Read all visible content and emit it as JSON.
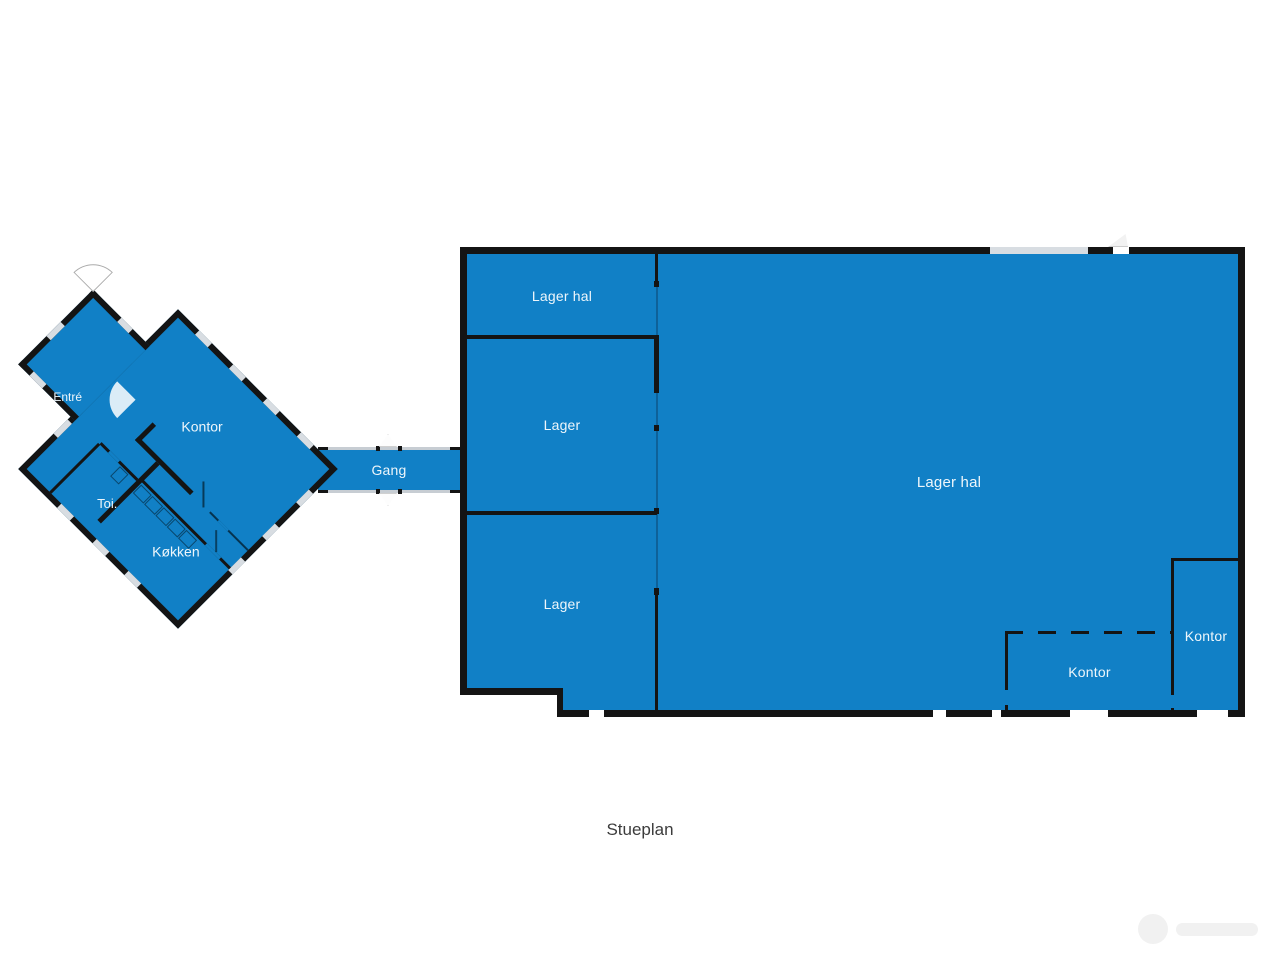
{
  "title": "Stueplan",
  "left_building": {
    "entre": "Entré",
    "kontor": "Kontor",
    "toilet": "Toi.",
    "kitchen": "Køkken"
  },
  "corridor": {
    "gang": "Gang"
  },
  "right_building": {
    "lager_hal_top": "Lager hal",
    "lager_mid": "Lager",
    "lager_bottom": "Lager",
    "lager_hal_main": "Lager hal",
    "kontor_inner": "Kontor",
    "kontor_corner": "Kontor"
  },
  "colors": {
    "fill": "#1180c6",
    "wall": "#141414",
    "window": "#d8dde2",
    "line": "#c7cdd3",
    "label": "#eef6fb",
    "title": "#3c3c3c",
    "watermark": "#f1f1f1"
  }
}
